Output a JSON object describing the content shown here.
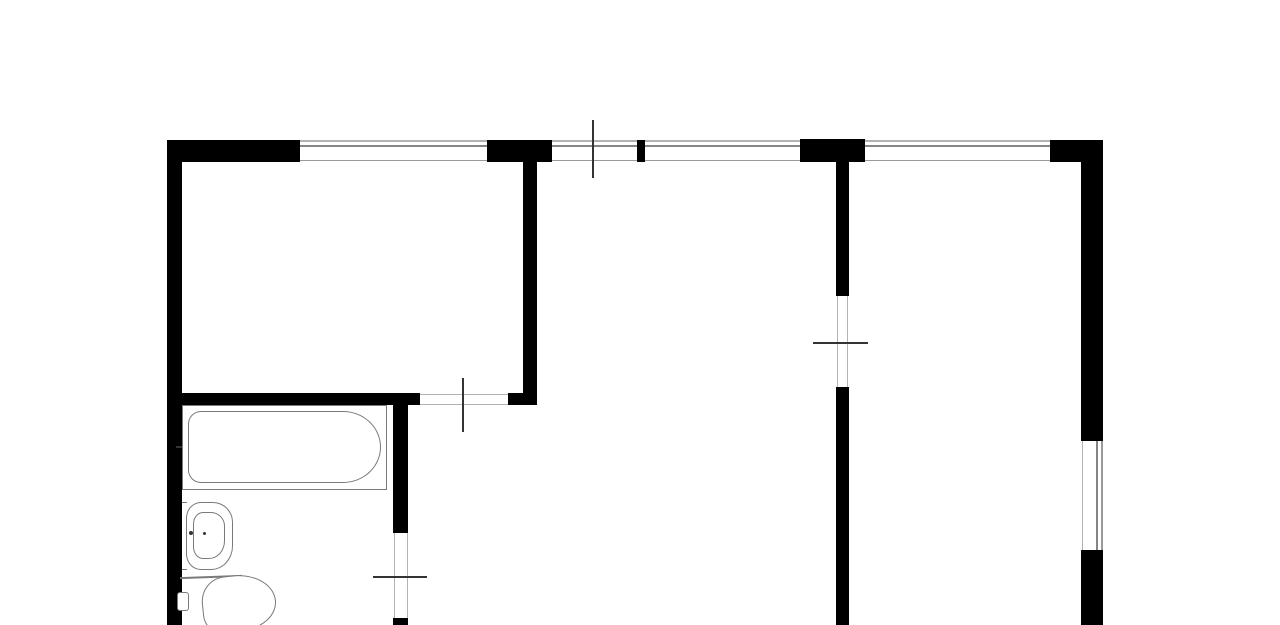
{
  "meta": {
    "title": "apartment-floor-plan"
  },
  "canvas": {
    "w": 1280,
    "h": 625,
    "bg": "#ffffff"
  },
  "colors": {
    "wall": "#000000",
    "edge": "#b2b2b2",
    "edge2": "#9a9a9a",
    "glass": "#858585",
    "tick": "#333333",
    "fix": "#7a7a7a"
  },
  "walls": [
    {
      "id": "top-wall-a",
      "x": 167,
      "y": 140,
      "w": 133,
      "h": 22
    },
    {
      "id": "top-wall-b",
      "x": 487,
      "y": 140,
      "w": 65,
      "h": 22
    },
    {
      "id": "top-wall-pier",
      "x": 637,
      "y": 140,
      "w": 8,
      "h": 22
    },
    {
      "id": "top-wall-junction",
      "x": 800,
      "y": 139,
      "w": 65,
      "h": 23
    },
    {
      "id": "top-wall-corner",
      "x": 1050,
      "y": 140,
      "w": 53,
      "h": 22
    },
    {
      "id": "left-wall",
      "x": 167,
      "y": 140,
      "w": 15,
      "h": 485
    },
    {
      "id": "living-room-right-wall",
      "x": 523,
      "y": 162,
      "w": 14,
      "h": 243
    },
    {
      "id": "living-room-bottom-wall",
      "x": 167,
      "y": 393,
      "w": 253,
      "h": 12
    },
    {
      "id": "living-room-bottom-stub",
      "x": 508,
      "y": 393,
      "w": 29,
      "h": 12
    },
    {
      "id": "bathroom-right-wall-upper",
      "x": 393,
      "y": 405,
      "w": 15,
      "h": 128
    },
    {
      "id": "bathroom-right-wall-lower",
      "x": 393,
      "y": 618,
      "w": 15,
      "h": 7
    },
    {
      "id": "hall-partition-wall-upper",
      "x": 836,
      "y": 162,
      "w": 13,
      "h": 134
    },
    {
      "id": "hall-partition-wall-lower",
      "x": 836,
      "y": 387,
      "w": 13,
      "h": 238
    },
    {
      "id": "right-wall-upper",
      "x": 1081,
      "y": 162,
      "w": 22,
      "h": 279
    },
    {
      "id": "right-wall-lower",
      "x": 1081,
      "y": 550,
      "w": 22,
      "h": 75
    }
  ],
  "windows": [
    {
      "id": "window-top-1",
      "dir": "h",
      "x": 300,
      "y": 140,
      "w": 187,
      "h": 22,
      "panes": [
        {
          "off": 0,
          "t": 1.5,
          "c": "edge"
        },
        {
          "off": 5,
          "t": 2,
          "c": "glass"
        },
        {
          "off": 19.5,
          "t": 1.5,
          "c": "edge2"
        }
      ]
    },
    {
      "id": "window-top-2",
      "dir": "h",
      "x": 552,
      "y": 140,
      "w": 85,
      "h": 22,
      "panes": [
        {
          "off": 0,
          "t": 1.5,
          "c": "edge"
        },
        {
          "off": 5,
          "t": 2,
          "c": "glass"
        },
        {
          "off": 19.5,
          "t": 1.5,
          "c": "edge2"
        }
      ]
    },
    {
      "id": "window-top-3",
      "dir": "h",
      "x": 645,
      "y": 140,
      "w": 155,
      "h": 22,
      "panes": [
        {
          "off": 0,
          "t": 1.5,
          "c": "edge"
        },
        {
          "off": 5,
          "t": 2,
          "c": "glass"
        },
        {
          "off": 19.5,
          "t": 1.5,
          "c": "edge2"
        }
      ]
    },
    {
      "id": "window-top-4",
      "dir": "h",
      "x": 865,
      "y": 140,
      "w": 185,
      "h": 22,
      "panes": [
        {
          "off": 0,
          "t": 1.5,
          "c": "edge"
        },
        {
          "off": 5,
          "t": 2,
          "c": "glass"
        },
        {
          "off": 19.5,
          "t": 1.5,
          "c": "edge2"
        }
      ]
    },
    {
      "id": "window-right-wall",
      "dir": "v",
      "x": 1081,
      "y": 441,
      "w": 22,
      "h": 109,
      "panes": [
        {
          "off": 0.5,
          "t": 1.5,
          "c": "edge"
        },
        {
          "off": 15,
          "t": 2,
          "c": "glass"
        },
        {
          "off": 20,
          "t": 1.5,
          "c": "edge2"
        }
      ]
    }
  ],
  "door_lines": [
    {
      "id": "living-room-door-jamb-top",
      "x": 420,
      "y": 393.5,
      "w": 88,
      "h": 1,
      "c": "edge"
    },
    {
      "id": "living-room-door-jamb-bottom",
      "x": 420,
      "y": 403.5,
      "w": 88,
      "h": 1,
      "c": "edge"
    },
    {
      "id": "bathroom-door-jamb-left",
      "x": 393.5,
      "y": 533,
      "w": 1,
      "h": 85,
      "c": "edge"
    },
    {
      "id": "bathroom-door-jamb-right",
      "x": 406.5,
      "y": 533,
      "w": 1,
      "h": 85,
      "c": "edge"
    },
    {
      "id": "hall-door-jamb-left",
      "x": 837,
      "y": 296,
      "w": 1,
      "h": 91,
      "c": "edge"
    },
    {
      "id": "hall-door-jamb-right",
      "x": 847,
      "y": 296,
      "w": 1,
      "h": 91,
      "c": "edge"
    }
  ],
  "ticks": [
    {
      "id": "balcony-door-tick",
      "x": 592,
      "y": 120,
      "w": 2,
      "h": 58,
      "c": "tick"
    },
    {
      "id": "living-room-door-tick",
      "x": 462,
      "y": 378,
      "w": 2,
      "h": 54,
      "c": "tick"
    },
    {
      "id": "hall-door-tick",
      "x": 813,
      "y": 342,
      "w": 55,
      "h": 2,
      "c": "tick"
    },
    {
      "id": "bathroom-door-tick",
      "x": 373,
      "y": 576,
      "w": 54,
      "h": 2,
      "c": "tick"
    }
  ],
  "fixture_lines": [
    {
      "id": "tub-faucet-mark",
      "x": 176,
      "y": 446,
      "w": 11,
      "h": 2,
      "c": "tick"
    },
    {
      "id": "sink-wall-join-top",
      "x": 182,
      "y": 502,
      "w": 5,
      "h": 1,
      "c": "fix"
    },
    {
      "id": "sink-wall-join-bottom",
      "x": 182,
      "y": 569,
      "w": 5,
      "h": 1,
      "c": "fix"
    },
    {
      "id": "toilet-inlet-line",
      "x": 180,
      "y": 576,
      "w": 62,
      "h": 1.5,
      "c": "fix",
      "rot": -2
    }
  ],
  "fixtures": [
    {
      "id": "bathtub-outline",
      "x": 182,
      "y": 405,
      "w": 205,
      "h": 85,
      "r": "0px",
      "c": "fix"
    },
    {
      "id": "bathtub-basin",
      "x": 188,
      "y": 411,
      "w": 193,
      "h": 72,
      "r": "13px 38px 38px 13px / 13px 36px 36px 13px",
      "c": "fix"
    },
    {
      "id": "sink-outline",
      "x": 186,
      "y": 502,
      "w": 47,
      "h": 68,
      "r": "15px 20px 22px 15px / 16px 20px 24px 16px",
      "c": "fix"
    },
    {
      "id": "sink-basin",
      "x": 193,
      "y": 512,
      "w": 32,
      "h": 47,
      "r": "10px 14px 16px 10px / 12px 14px 18px 12px",
      "c": "fix"
    },
    {
      "id": "toilet-tank",
      "x": 177,
      "y": 592,
      "w": 12,
      "h": 19,
      "r": "3px",
      "c": "fix"
    },
    {
      "id": "toilet-bowl",
      "x": 202,
      "y": 575,
      "w": 74,
      "h": 56,
      "r": "38% 62% 55% 30% / 52% 60% 55% 38%",
      "rot": -6,
      "c": "fix"
    }
  ],
  "dots": [
    {
      "id": "sink-faucet-dot-left",
      "x": 189,
      "y": 531,
      "w": 4,
      "h": 4,
      "r": "50%",
      "c": "tick"
    },
    {
      "id": "sink-faucet-dot-right",
      "x": 203,
      "y": 532,
      "w": 3,
      "h": 3,
      "r": "50%",
      "c": "tick"
    }
  ]
}
